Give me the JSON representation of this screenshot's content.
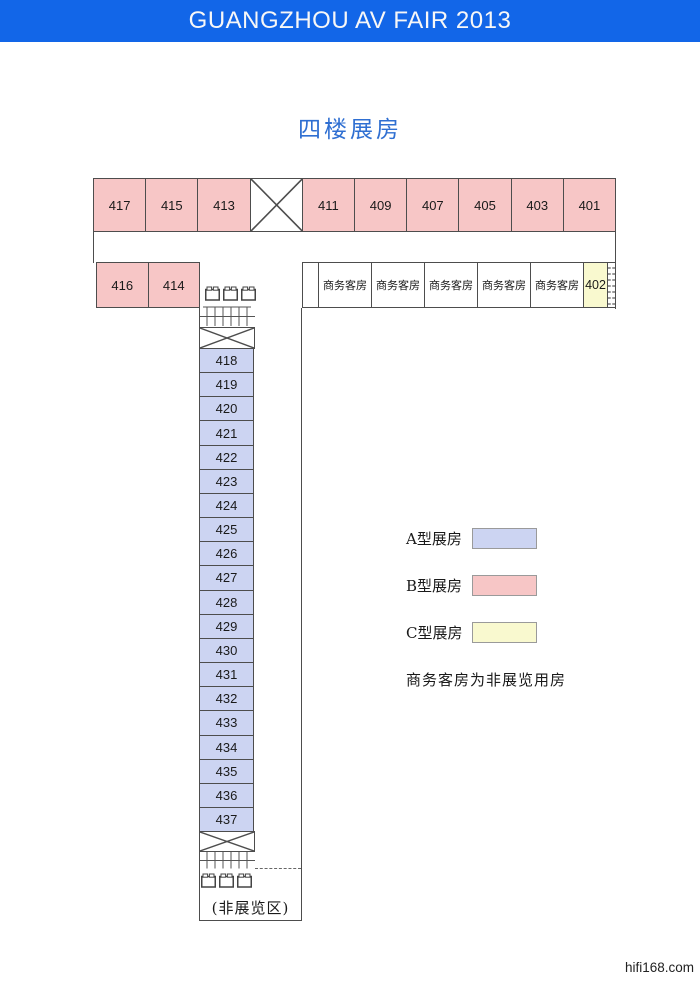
{
  "banner": {
    "title": "GUANGZHOU AV FAIR 2013"
  },
  "title": "四楼展房",
  "colors": {
    "banner_bg": "#1266e8",
    "title": "#2f6fd2",
    "wall": "#4d4d4d",
    "type_a": "#ccd4f2",
    "type_b": "#f7c6c6",
    "type_c": "#f9f9cf"
  },
  "plan": {
    "top_left_rooms": [
      "417",
      "415",
      "413"
    ],
    "top_right_rooms": [
      "411",
      "409",
      "407",
      "405",
      "403",
      "401"
    ],
    "row2_rooms": [
      "416",
      "414"
    ],
    "business_label": "商务客房",
    "room_402": "402",
    "column_rooms": [
      "418",
      "419",
      "420",
      "421",
      "422",
      "423",
      "424",
      "425",
      "426",
      "427",
      "428",
      "429",
      "430",
      "431",
      "432",
      "433",
      "434",
      "435",
      "436",
      "437"
    ],
    "non_exhibit_label": "(非展览区)"
  },
  "legend": {
    "items": [
      {
        "label": "A型展房",
        "color": "#ccd4f2"
      },
      {
        "label": "B型展房",
        "color": "#f7c6c6"
      },
      {
        "label": "C型展房",
        "color": "#f9f9cf"
      }
    ],
    "note": "商务客房为非展览用房"
  },
  "footer": {
    "site": "hifi168.com"
  }
}
